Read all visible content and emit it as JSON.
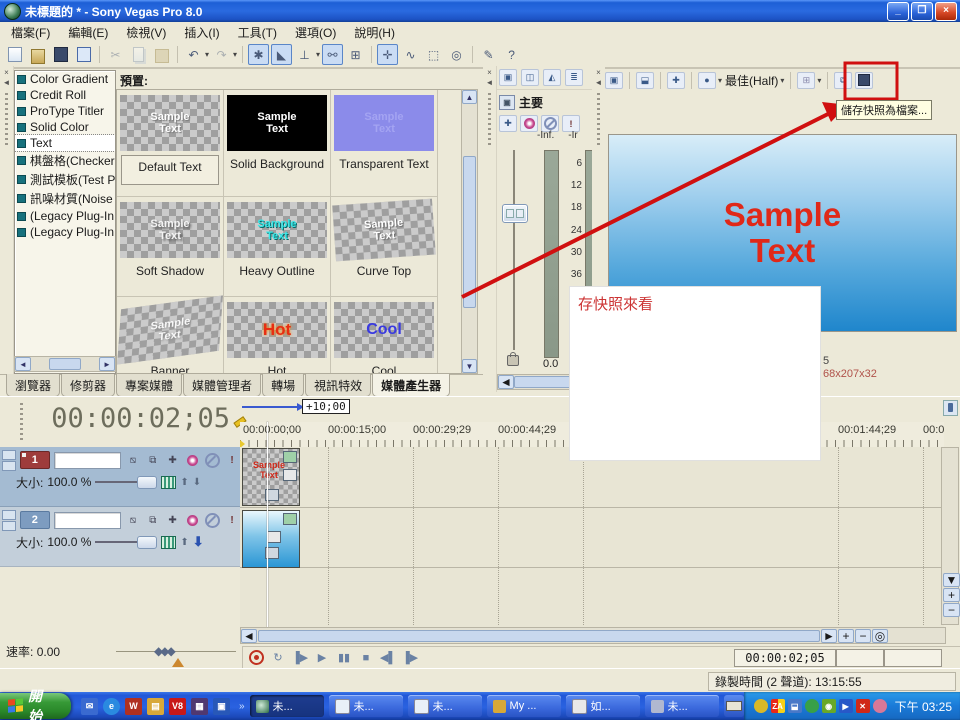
{
  "window": {
    "title": "未標題的 * - Sony Vegas Pro 8.0"
  },
  "menu": {
    "items": [
      "檔案(F)",
      "編輯(E)",
      "檢視(V)",
      "插入(I)",
      "工具(T)",
      "選項(O)",
      "說明(H)"
    ]
  },
  "generators": {
    "items": [
      "Color Gradient",
      "Credit Roll",
      "ProType Titler",
      "Solid Color",
      "Text",
      "棋盤格(Checkerl",
      "測試模板(Test P",
      "訊噪材質(Noise",
      "(Legacy Plug-In",
      "(Legacy Plug-In"
    ]
  },
  "presets": {
    "label": "預置:",
    "cells": [
      {
        "label": "Default Text",
        "thumb": "Sample Text"
      },
      {
        "label": "Solid Background",
        "thumb": "Sample Text"
      },
      {
        "label": "Transparent Text",
        "thumb": "Sample Text"
      },
      {
        "label": "Soft Shadow",
        "thumb": "Sample Text"
      },
      {
        "label": "Heavy Outline",
        "thumb": "Sample Text"
      },
      {
        "label": "Curve Top",
        "thumb": "Sample Text"
      },
      {
        "label": "Banner",
        "thumb": "Sample Text"
      },
      {
        "label": "Hot",
        "thumb": "Hot"
      },
      {
        "label": "Cool",
        "thumb": "Cool"
      }
    ]
  },
  "tabs": {
    "items": [
      "瀏覽器",
      "修剪器",
      "專案媒體",
      "媒體管理者",
      "轉場",
      "視訊特效",
      "媒體產生器"
    ]
  },
  "mixer": {
    "title": "主要",
    "db_left": "-Inf.",
    "db_right": "-Ir",
    "scale": [
      "6",
      "12",
      "18",
      "24",
      "30",
      "36",
      "42",
      "48",
      "54"
    ],
    "level": "0.0"
  },
  "preview": {
    "quality": "最佳(Half)",
    "frame_line1": "Sample",
    "frame_line2": "Text",
    "info_top": "5",
    "info_bottom": "68x207x32",
    "save_tooltip": "儲存快照為檔案..."
  },
  "annotation": {
    "note": "存快照來看"
  },
  "timeline": {
    "timecode": "00:00:02;05",
    "drag_offset": "+10;00",
    "ruler": [
      "00:00:00;00",
      "00:00:15;00",
      "00:00:29;29",
      "00:00:44;29",
      "00:01:44;29",
      "00:0"
    ],
    "rate_label": "速率:",
    "rate_value": "0.00",
    "clip_text": "Sample Text"
  },
  "tracks": [
    {
      "number": "1",
      "size_label": "大小:",
      "size_value": "100.0 %"
    },
    {
      "number": "2",
      "size_label": "大小:",
      "size_value": "100.0 %"
    }
  ],
  "transport": {
    "timecode": "00:00:02;05"
  },
  "statusbar": {
    "record_time": "錄製時間 (2 聲道): 13:15:55"
  },
  "taskbar": {
    "start": "開始",
    "windows": [
      "未...",
      "未...",
      "未...",
      "My ...",
      "如...",
      "未..."
    ],
    "clock": "下午 03:25"
  }
}
